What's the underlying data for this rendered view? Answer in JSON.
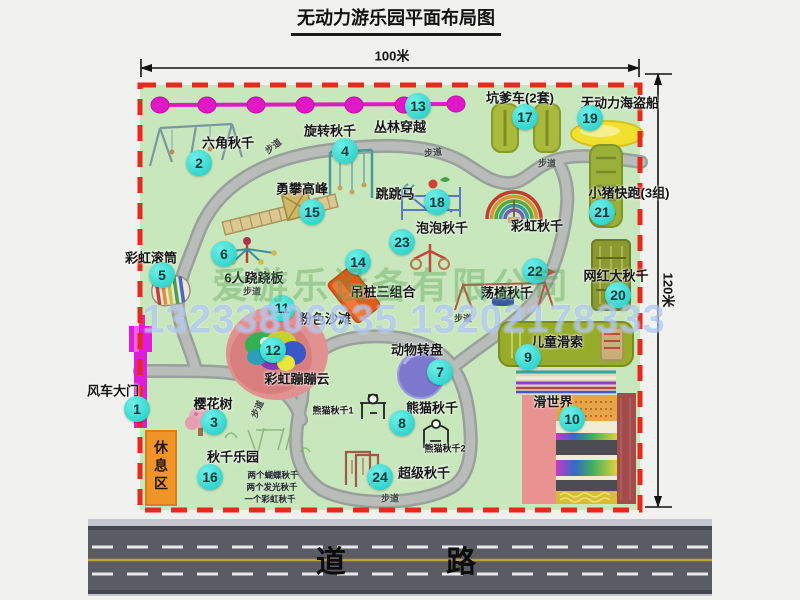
{
  "title": "无动力游乐园平面布局图",
  "dimensions": {
    "width_label": "100米",
    "height_label": "120米"
  },
  "road": {
    "label": "道 路"
  },
  "watermark": {
    "company": "爱游乐设备有限公司",
    "phones": "13233806635 13202178333"
  },
  "rest_area": {
    "label": "休息区"
  },
  "path_label_text": "步道",
  "path_labels": [
    {
      "x": 273,
      "y": 146,
      "r": -38
    },
    {
      "x": 433,
      "y": 152,
      "r": -6
    },
    {
      "x": 547,
      "y": 163,
      "r": 0
    },
    {
      "x": 252,
      "y": 291,
      "r": 0
    },
    {
      "x": 463,
      "y": 318,
      "r": 0
    },
    {
      "x": 257,
      "y": 409,
      "r": -65
    },
    {
      "x": 390,
      "y": 498,
      "r": 0
    }
  ],
  "attractions": [
    {
      "n": "1",
      "label": "风车大门",
      "bx": 137,
      "by": 409,
      "lx": 113,
      "ly": 390
    },
    {
      "n": "2",
      "label": "六角秋千",
      "bx": 199,
      "by": 163,
      "lx": 228,
      "ly": 142
    },
    {
      "n": "3",
      "label": "樱花树",
      "bx": 214,
      "by": 422,
      "lx": 213,
      "ly": 403
    },
    {
      "n": "4",
      "label": "旋转秋千",
      "bx": 345,
      "by": 151,
      "lx": 330,
      "ly": 130
    },
    {
      "n": "5",
      "label": "彩虹滚筒",
      "bx": 162,
      "by": 275,
      "lx": 151,
      "ly": 257
    },
    {
      "n": "6",
      "label": "6人跷跷板",
      "bx": 224,
      "by": 254,
      "lx": 254,
      "ly": 277
    },
    {
      "n": "7",
      "label": "动物转盘",
      "bx": 440,
      "by": 372,
      "lx": 417,
      "ly": 349
    },
    {
      "n": "8",
      "label": "熊猫秋千",
      "bx": 402,
      "by": 423,
      "lx": 432,
      "ly": 407
    },
    {
      "n": "9",
      "label": "儿童滑索",
      "bx": 528,
      "by": 357,
      "lx": 557,
      "ly": 341
    },
    {
      "n": "10",
      "label": "滑世界",
      "bx": 572,
      "by": 419,
      "lx": 553,
      "ly": 401
    },
    {
      "n": "11",
      "label": "粉色沙滩",
      "bx": 282,
      "by": 308,
      "lx": 325,
      "ly": 318
    },
    {
      "n": "12",
      "label": "彩虹蹦蹦云",
      "bx": 273,
      "by": 350,
      "lx": 297,
      "ly": 378
    },
    {
      "n": "13",
      "label": "丛林穿越",
      "bx": 418,
      "by": 106,
      "lx": 400,
      "ly": 126
    },
    {
      "n": "14",
      "label": "吊桩三组合",
      "bx": 358,
      "by": 262,
      "lx": 383,
      "ly": 291
    },
    {
      "n": "15",
      "label": "勇攀高峰",
      "bx": 312,
      "by": 212,
      "lx": 302,
      "ly": 188
    },
    {
      "n": "16",
      "label": "秋千乐园",
      "bx": 210,
      "by": 477,
      "lx": 233,
      "ly": 456
    },
    {
      "n": "17",
      "label": "坑爹车(2套)",
      "bx": 525,
      "by": 117,
      "lx": 520,
      "ly": 97
    },
    {
      "n": "18",
      "label": "跳跳马",
      "bx": 437,
      "by": 202,
      "lx": 395,
      "ly": 193
    },
    {
      "n": "19",
      "label": "无动力海盗船",
      "bx": 590,
      "by": 118,
      "lx": 620,
      "ly": 102
    },
    {
      "n": "20",
      "label": "网红大秋千",
      "bx": 618,
      "by": 295,
      "lx": 616,
      "ly": 275
    },
    {
      "n": "21",
      "label": "小猪快跑(3组)",
      "bx": 602,
      "by": 212,
      "lx": 629,
      "ly": 192
    },
    {
      "n": "22",
      "label": "荡椅秋千",
      "bx": 535,
      "by": 271,
      "lx": 507,
      "ly": 292
    },
    {
      "n": "23",
      "label": "泡泡秋千",
      "bx": 402,
      "by": 242,
      "lx": 442,
      "ly": 227
    },
    {
      "n": "24",
      "label": "超级秋千",
      "bx": 380,
      "by": 477,
      "lx": 424,
      "ly": 472
    }
  ],
  "extra_labels": [
    {
      "text": "彩虹秋千",
      "x": 537,
      "y": 225,
      "cls": ""
    },
    {
      "text": "熊猫秋千1",
      "x": 333,
      "y": 410,
      "cls": "sm"
    },
    {
      "text": "熊猫秋千2",
      "x": 445,
      "y": 448,
      "cls": "sm"
    }
  ],
  "swing_park_notes": [
    {
      "text": "两个蝴蝶秋千",
      "x": 273,
      "y": 475
    },
    {
      "text": "两个发光秋千",
      "x": 272,
      "y": 487
    },
    {
      "text": "一个彩虹秋千",
      "x": 270,
      "y": 499
    }
  ],
  "colors": {
    "park_green": "#c9e7bd",
    "border_red": "#e6281d",
    "badge_cyan": "#1ec9c3",
    "zipline_magenta": "#e018c6",
    "gate_magenta": "#df1cd8",
    "rest_orange": "#f09428",
    "road_gray": "#5b5b64",
    "carousel_purple": "#7b78cd",
    "pirate_yellow": "#f0e030"
  }
}
